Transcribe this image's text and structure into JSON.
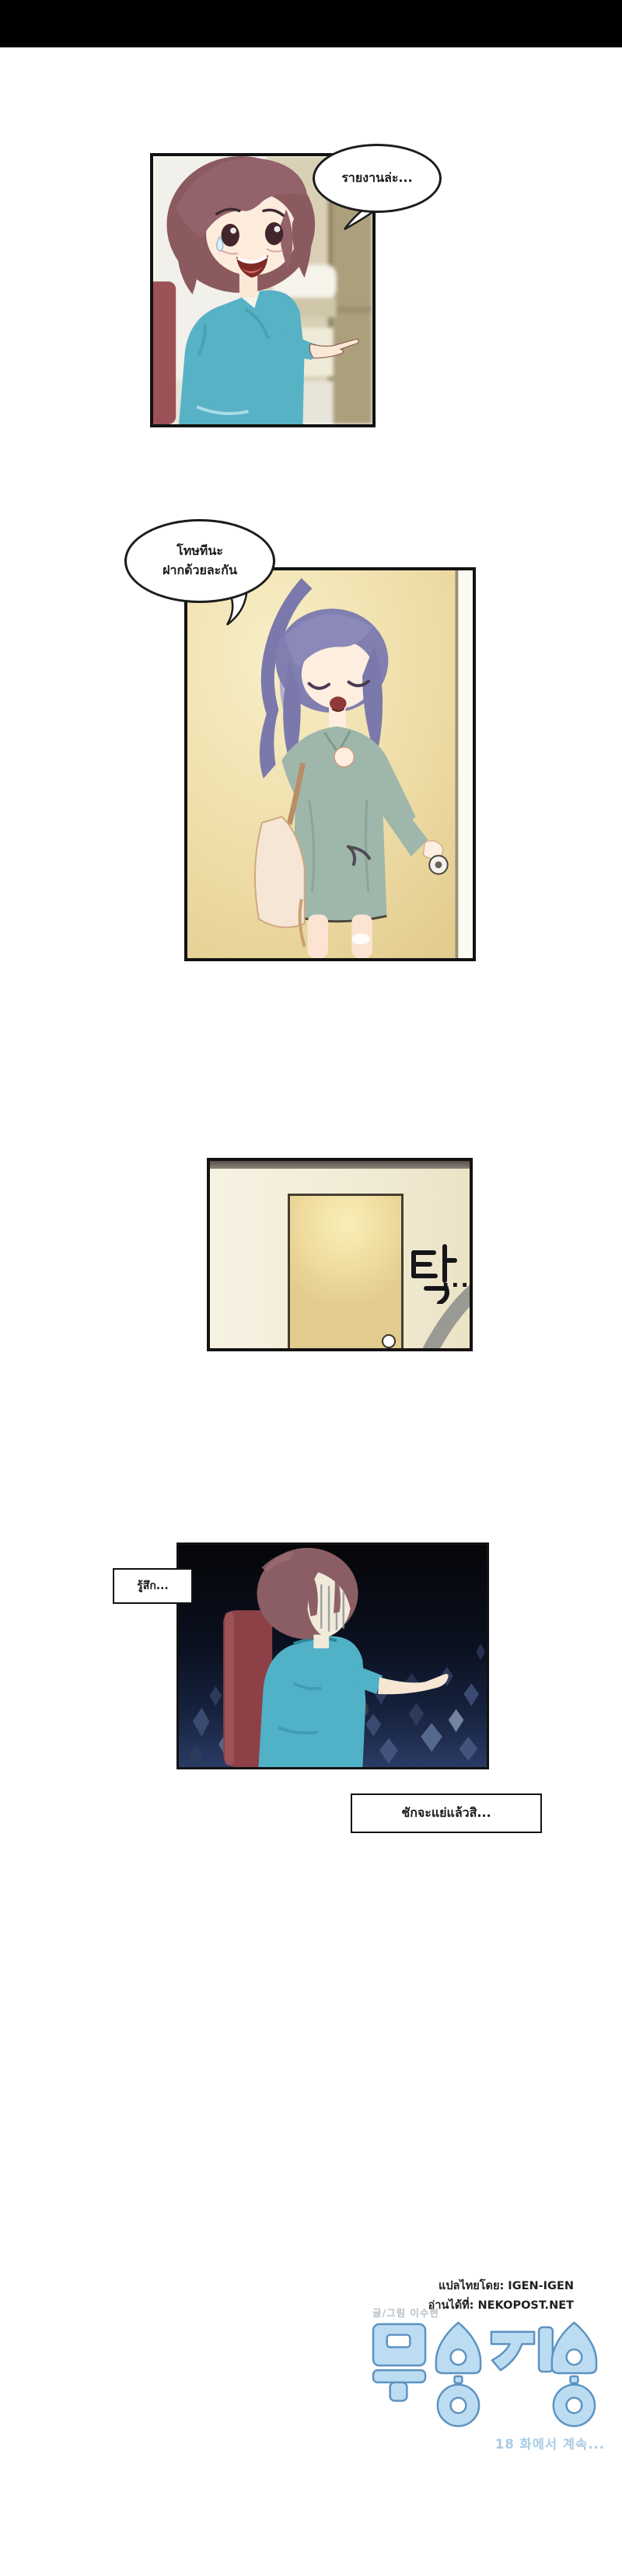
{
  "panel1": {
    "bubble_text": "รายงานล่ะ..."
  },
  "panel2": {
    "bubble_line1": "โทษทีนะ",
    "bubble_line2": "ฝากด้วยละกัน"
  },
  "panel3": {
    "sfx_text": "탁",
    "sfx_ellipsis": "..."
  },
  "panel4": {
    "caption_top": "รู้สึก...",
    "caption_bottom": "ชักจะแย่แล้วสิ..."
  },
  "footer": {
    "translator_credit": "แปลไทยโดย: IGEN-IGEN",
    "source_credit": "อ่านได้ที่: NEKOPOST.NET",
    "author_credit": "글/그림 이수현",
    "logo_text": "무용지용",
    "continue_text": "18 화에서 계속..."
  },
  "colors": {
    "top_bar": "#000000",
    "logo_fill": "#bcdcf2",
    "logo_outline": "#5d92c2",
    "continue_text_color": "#a9cbe5",
    "shirt_teal": "#50b1c7",
    "chair_red": "#8d4046",
    "hair_brown": "#8a5a5f",
    "hair_purple": "#7b78ab",
    "dress_sage": "#9fb7ab",
    "door_cream": "#ead79e",
    "panel4_bg_bottom": "#2a3a63"
  }
}
